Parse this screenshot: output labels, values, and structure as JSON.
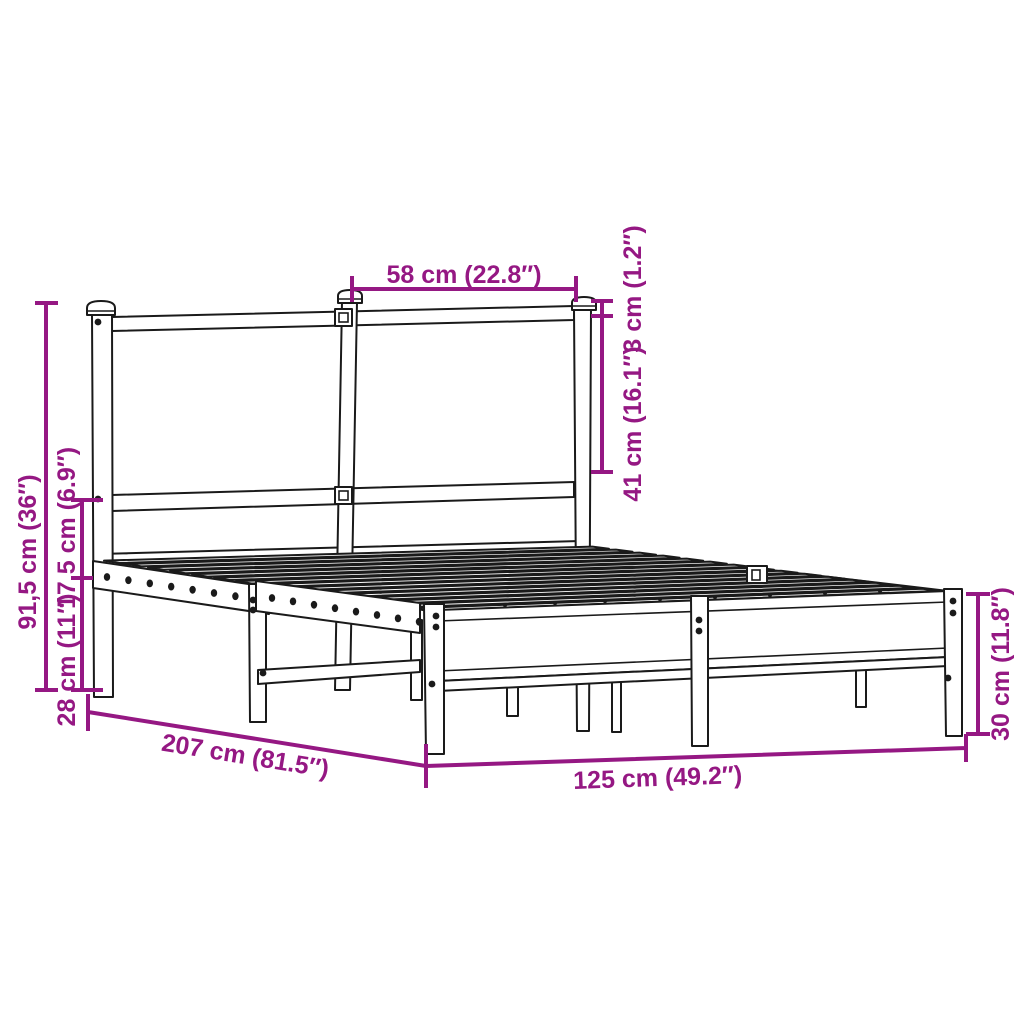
{
  "page": {
    "title": "Metal bed frame with headboard — dimension diagram",
    "background": "#ffffff"
  },
  "diagram": {
    "type": "product dimension line drawing, perspective view",
    "subject": "metal bed frame with headboard and slatted base",
    "line_color": "#1a1a1a",
    "annotation_color": "#951883",
    "dimensions": [
      {
        "id": "headboard-panel-width",
        "label": "58 cm (22.8″)",
        "orientation": "horizontal-top"
      },
      {
        "id": "top-rail-thickness",
        "label": "3 cm (1.2″)",
        "orientation": "vertical-right-of-headboard"
      },
      {
        "id": "headboard-panel-height",
        "label": "41 cm (16.1″)",
        "orientation": "vertical-right-of-headboard"
      },
      {
        "id": "headboard-total-height",
        "label": "91,5 cm (36″)",
        "orientation": "vertical-left"
      },
      {
        "id": "headboard-lower-height",
        "label": "17,5 cm (6.9″)",
        "orientation": "vertical-left"
      },
      {
        "id": "under-bed-clearance",
        "label": "28 cm (11″)",
        "orientation": "vertical-left"
      },
      {
        "id": "frame-length",
        "label": "207 cm (81.5″)",
        "orientation": "diagonal-bottom-left"
      },
      {
        "id": "frame-width",
        "label": "125 cm (49.2″)",
        "orientation": "horizontal-bottom"
      },
      {
        "id": "frame-height",
        "label": "30 cm (11.8″)",
        "orientation": "vertical-right"
      }
    ]
  }
}
